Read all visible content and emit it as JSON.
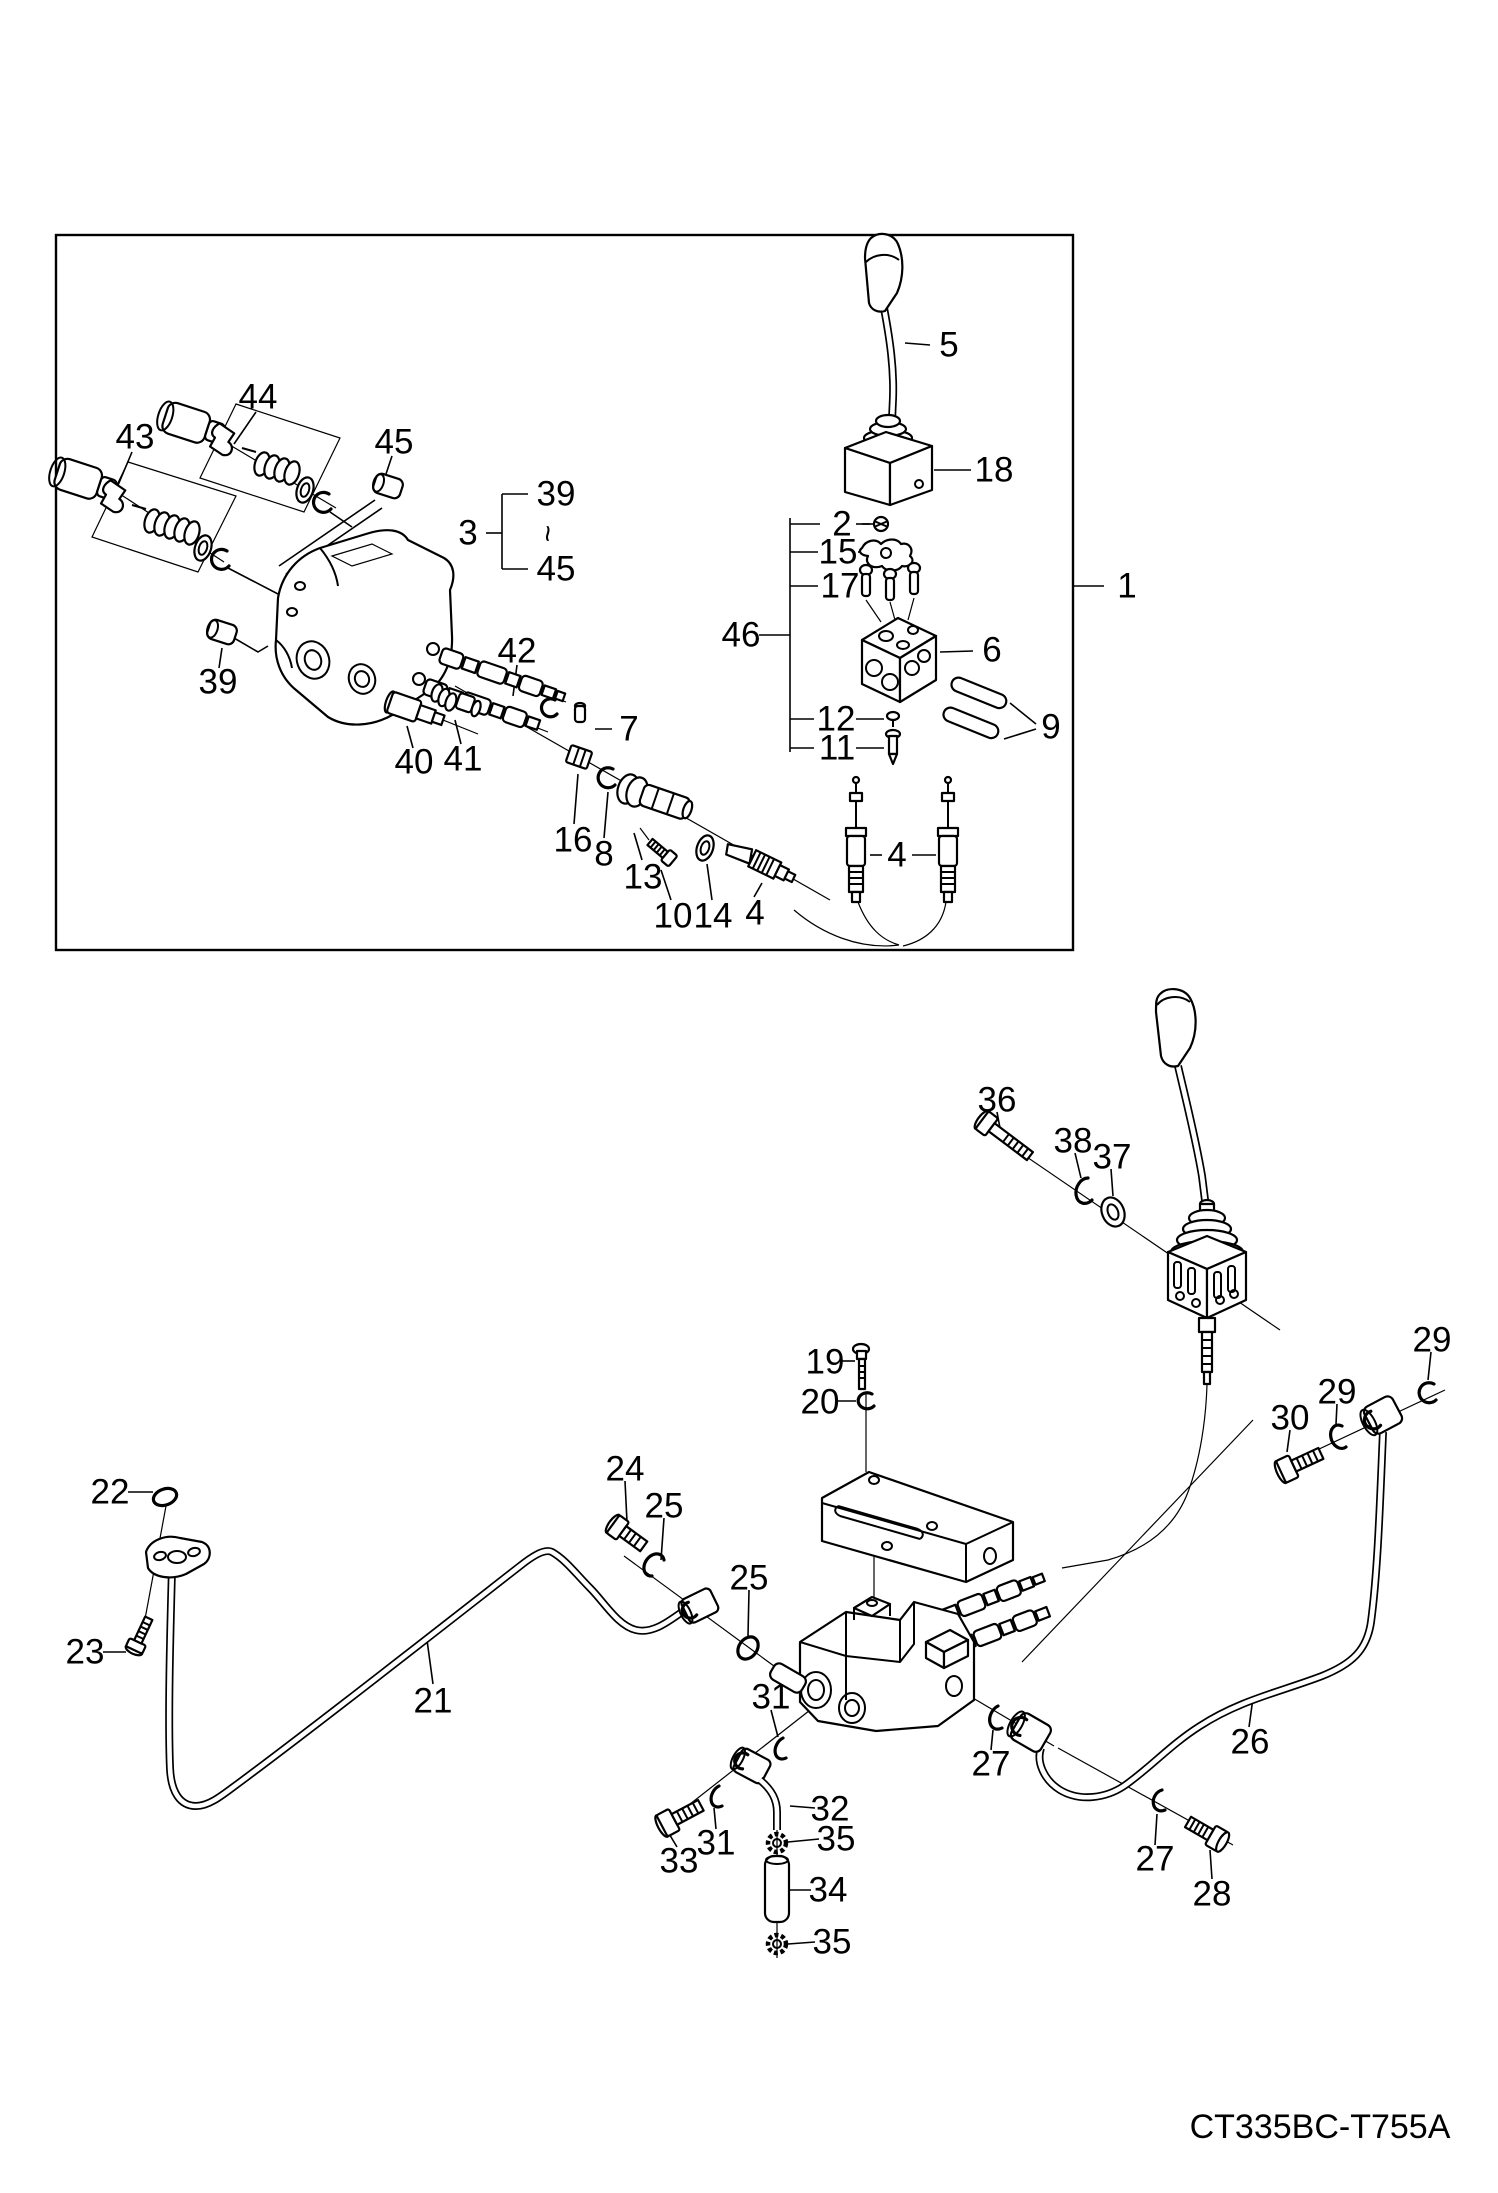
{
  "drawing_code": "CT335BC-T755A",
  "callouts": [
    {
      "ref": "lever",
      "text": "5"
    },
    {
      "ref": "pilot-valve-body",
      "text": "18"
    },
    {
      "ref": "nut",
      "text": "2"
    },
    {
      "ref": "cam",
      "text": "15"
    },
    {
      "ref": "plungers",
      "text": "17"
    },
    {
      "ref": "valve-group",
      "text": "46"
    },
    {
      "ref": "valve-block",
      "text": "6"
    },
    {
      "ref": "sleeves",
      "text": "9"
    },
    {
      "ref": "pin",
      "text": "12"
    },
    {
      "ref": "rod",
      "text": "11"
    },
    {
      "ref": "range-ref",
      "text": "3"
    },
    {
      "ref": "range-start",
      "text": "39"
    },
    {
      "ref": "range-tilde",
      "text": "~"
    },
    {
      "ref": "range-end",
      "text": "45"
    },
    {
      "ref": "spool-kit-upper",
      "text": "44"
    },
    {
      "ref": "spool-kit-lower",
      "text": "43"
    },
    {
      "ref": "plug-right",
      "text": "45"
    },
    {
      "ref": "plug-left",
      "text": "39"
    },
    {
      "ref": "spool",
      "text": "42"
    },
    {
      "ref": "relief-valve",
      "text": "40"
    },
    {
      "ref": "relief-fitting",
      "text": "41"
    },
    {
      "ref": "pin-small",
      "text": "7"
    },
    {
      "ref": "nut-16",
      "text": "16"
    },
    {
      "ref": "snap-ring-8",
      "text": "8"
    },
    {
      "ref": "spool-end-13",
      "text": "13"
    },
    {
      "ref": "bolt-10",
      "text": "10"
    },
    {
      "ref": "washer-14",
      "text": "14"
    },
    {
      "ref": "cable-end-4",
      "text": "4"
    },
    {
      "ref": "cables-4",
      "text": "4"
    },
    {
      "ref": "assembly-1",
      "text": "1"
    },
    {
      "ref": "bolt-36",
      "text": "36"
    },
    {
      "ref": "washer-38",
      "text": "38"
    },
    {
      "ref": "washer-37",
      "text": "37"
    },
    {
      "ref": "screw-19",
      "text": "19"
    },
    {
      "ref": "washer-20",
      "text": "20"
    },
    {
      "ref": "snap-ring-29-right",
      "text": "29"
    },
    {
      "ref": "washer-29-mid",
      "text": "29"
    },
    {
      "ref": "bolt-30",
      "text": "30"
    },
    {
      "ref": "o-ring-22",
      "text": "22"
    },
    {
      "ref": "screw-23",
      "text": "23"
    },
    {
      "ref": "bolt-24",
      "text": "24"
    },
    {
      "ref": "washer-25-a",
      "text": "25"
    },
    {
      "ref": "washer-25-b",
      "text": "25"
    },
    {
      "ref": "pipe-21",
      "text": "21"
    },
    {
      "ref": "washer-31-top",
      "text": "31"
    },
    {
      "ref": "washer-27-left",
      "text": "27"
    },
    {
      "ref": "pipe-26",
      "text": "26"
    },
    {
      "ref": "bolt-33",
      "text": "33"
    },
    {
      "ref": "washer-31-bottom",
      "text": "31"
    },
    {
      "ref": "pipe-32",
      "text": "32"
    },
    {
      "ref": "clamp-35-upper",
      "text": "35"
    },
    {
      "ref": "hose-34",
      "text": "34"
    },
    {
      "ref": "clamp-35-lower",
      "text": "35"
    },
    {
      "ref": "washer-27-right",
      "text": "27"
    },
    {
      "ref": "bolt-28",
      "text": "28"
    }
  ]
}
